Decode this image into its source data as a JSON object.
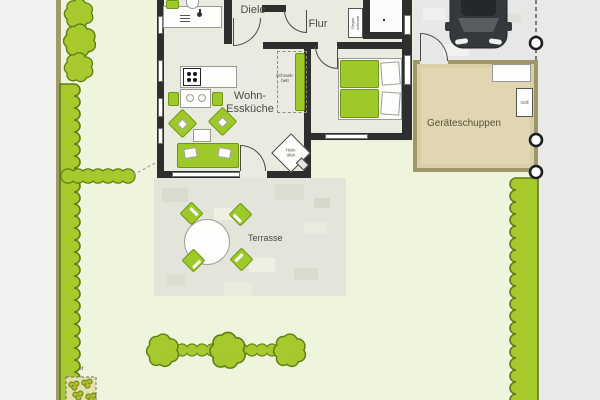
{
  "plan": {
    "rooms": {
      "diele": "Diele",
      "flur": "Flur",
      "wohn_esskueche": {
        "line1": "Wohn-",
        "line2": "Essküche"
      }
    },
    "fixtures": {
      "schrankbett": {
        "line1": "Schrank-",
        "line2": "bett"
      },
      "regalschrank": {
        "line1": "Regal-",
        "line2": "schrank"
      },
      "holzofen": {
        "line1": "Holz-",
        "line2": "ofen"
      },
      "grill": "Grill"
    },
    "outdoor": {
      "terrasse": "Terrasse",
      "geraeteschuppen": "Geräteschuppen",
      "kraeuter": "Kräuter"
    },
    "colors": {
      "garden": "#eff5dc",
      "hedge": "#a6c92e",
      "hedge_outline": "#5e7d12",
      "house_floor": "#e9ebe0",
      "wall": "#2e2e2e",
      "furniture_green": "#9dc929",
      "shed_fill": "#d9cfa7",
      "shed_border": "#a09768",
      "paving": "#e7e7e5",
      "street": "#e9e9e7",
      "terrace": "#e4e5da",
      "boundary_line": "#a39a6a",
      "car": "#34393b"
    }
  }
}
